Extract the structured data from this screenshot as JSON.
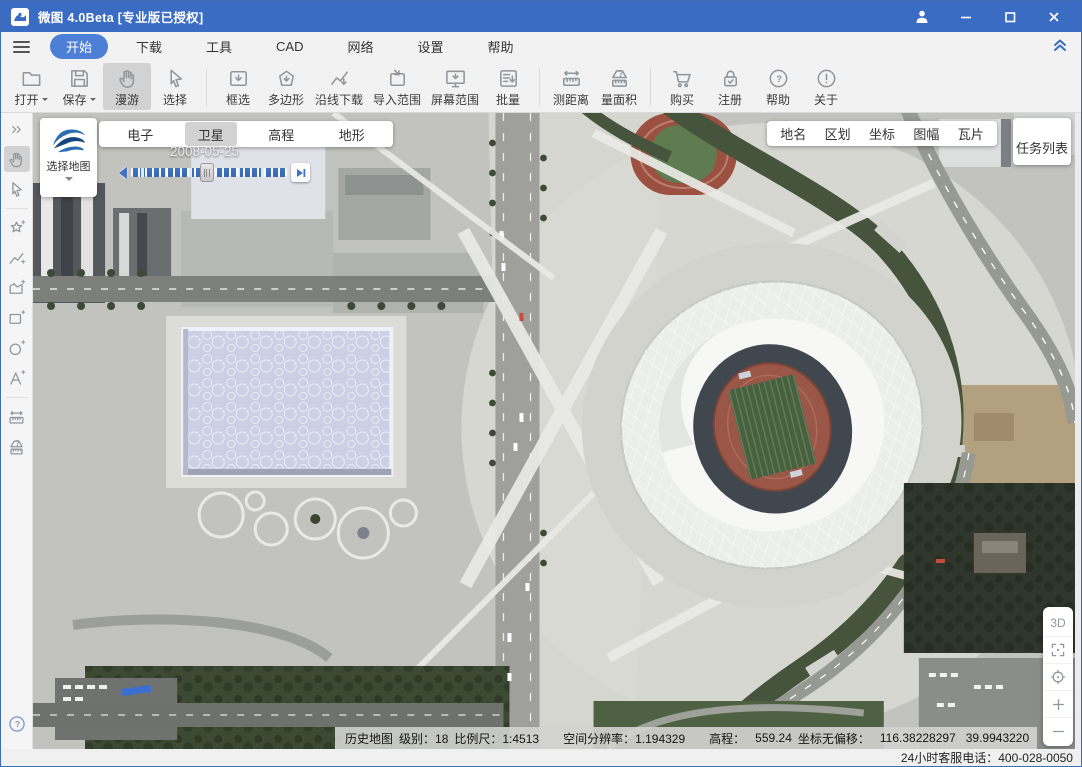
{
  "window": {
    "title": "微图 4.0Beta [专业版已授权]"
  },
  "menu": {
    "items": [
      {
        "label": "开始"
      },
      {
        "label": "下载"
      },
      {
        "label": "工具"
      },
      {
        "label": "CAD"
      },
      {
        "label": "网络"
      },
      {
        "label": "设置"
      },
      {
        "label": "帮助"
      }
    ],
    "active": "开始"
  },
  "toolbar": {
    "items": [
      {
        "label": "打开",
        "icon": "folder-open-icon",
        "dropdown": true
      },
      {
        "label": "保存",
        "icon": "save-icon",
        "dropdown": true
      },
      {
        "label": "漫游",
        "icon": "hand-icon",
        "active": true
      },
      {
        "label": "选择",
        "icon": "cursor-icon"
      },
      {
        "label": "框选",
        "icon": "box-download-icon"
      },
      {
        "label": "多边形",
        "icon": "polygon-download-icon"
      },
      {
        "label": "沿线下载",
        "icon": "polyline-download-icon"
      },
      {
        "label": "导入范围",
        "icon": "import-extent-icon"
      },
      {
        "label": "屏幕范围",
        "icon": "screen-extent-icon"
      },
      {
        "label": "批量",
        "icon": "batch-icon"
      },
      {
        "label": "测距离",
        "icon": "measure-distance-icon"
      },
      {
        "label": "量面积",
        "icon": "measure-area-icon"
      },
      {
        "label": "购买",
        "icon": "cart-icon"
      },
      {
        "label": "注册",
        "icon": "lock-icon"
      },
      {
        "label": "帮助",
        "icon": "help-icon"
      },
      {
        "label": "关于",
        "icon": "about-icon"
      }
    ]
  },
  "map": {
    "select_map_label": "选择地图",
    "layer_tabs": [
      {
        "label": "电子"
      },
      {
        "label": "卫星",
        "active": true
      },
      {
        "label": "高程"
      },
      {
        "label": "地形"
      }
    ],
    "timeline": {
      "date": "2008-05-25"
    },
    "overlay_buttons": [
      {
        "label": "地名"
      },
      {
        "label": "区划"
      },
      {
        "label": "坐标"
      },
      {
        "label": "图幅"
      },
      {
        "label": "瓦片"
      }
    ],
    "task_list_label": "任务列表",
    "view_controls": {
      "mode_3d": "3D"
    }
  },
  "status_bar": {
    "map_type": "历史地图",
    "level": "级别：18",
    "scale": "比例尺：1:4513",
    "resolution": "空间分辨率：1.194329",
    "elevation_label": "高程：",
    "elevation_value": "559.24",
    "coords_label": "坐标无偏移：",
    "longitude": "116.38228297",
    "latitude": "39.9943220"
  },
  "footer": {
    "service_phone": "24小时客服电话：400-028-0050"
  }
}
